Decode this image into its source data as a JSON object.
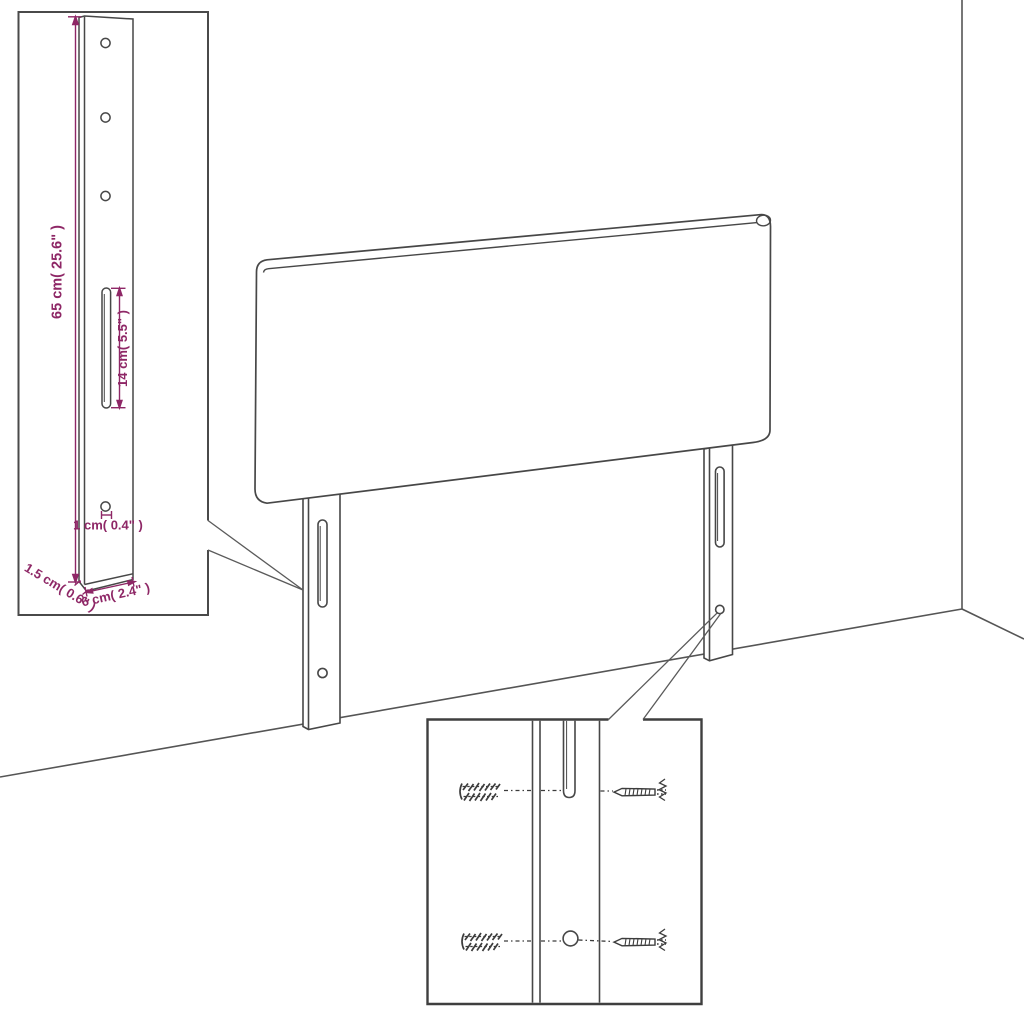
{
  "diagram": {
    "type": "furniture-assembly-dimension-diagram",
    "subject": "upholstered headboard with two slotted mounting legs, shown against a room wall corner",
    "colors": {
      "background": "#ffffff",
      "line": "#474747",
      "accent": "#8E2766"
    },
    "labels": {
      "leg_height": "65 cm( 25.6\" )",
      "slot_length": "14 cm( 5.5\" )",
      "hole_diameter": "1 cm( 0.4\" )",
      "leg_thickness": "1.5 cm( 0.6\" )",
      "leg_width": "6 cm( 2.4\" )"
    },
    "insets": {
      "leg_detail": {
        "holes_round": 4,
        "slots": 1,
        "dimension_labels": 5
      },
      "hardware_detail": {
        "wall_plugs": 2,
        "screws": 2,
        "slots": 1,
        "holes": 1
      }
    }
  }
}
